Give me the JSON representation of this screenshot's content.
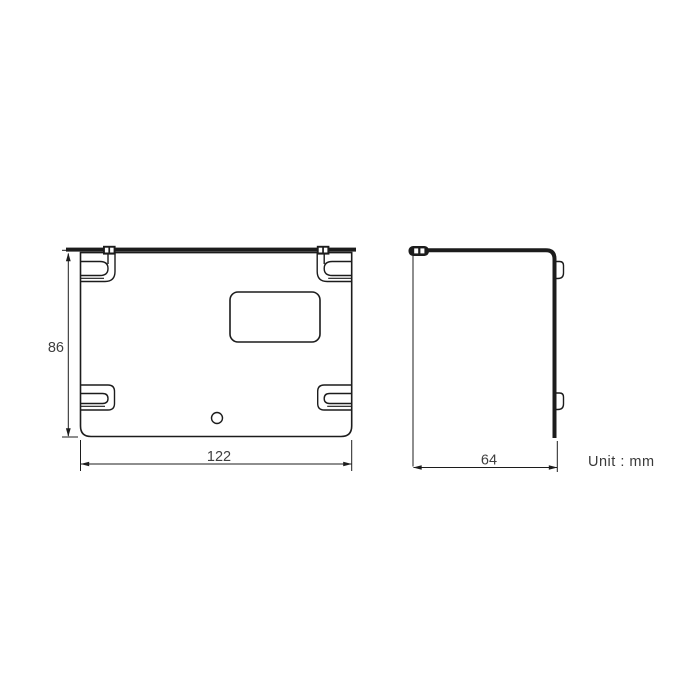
{
  "drawing": {
    "type": "technical-drawing",
    "unit_note": "Unit : mm",
    "colors": {
      "line": "#1c1c1c",
      "text": "#3e3e3e",
      "background": "#ffffff"
    },
    "front_view": {
      "description": "mounting bracket front view with four corner hook slots, rounded rectangular opening and screw hole",
      "height_dim": "86",
      "width_dim": "122"
    },
    "side_view": {
      "description": "bracket side profile with top flange and two hook tabs",
      "depth_dim": "64"
    }
  }
}
